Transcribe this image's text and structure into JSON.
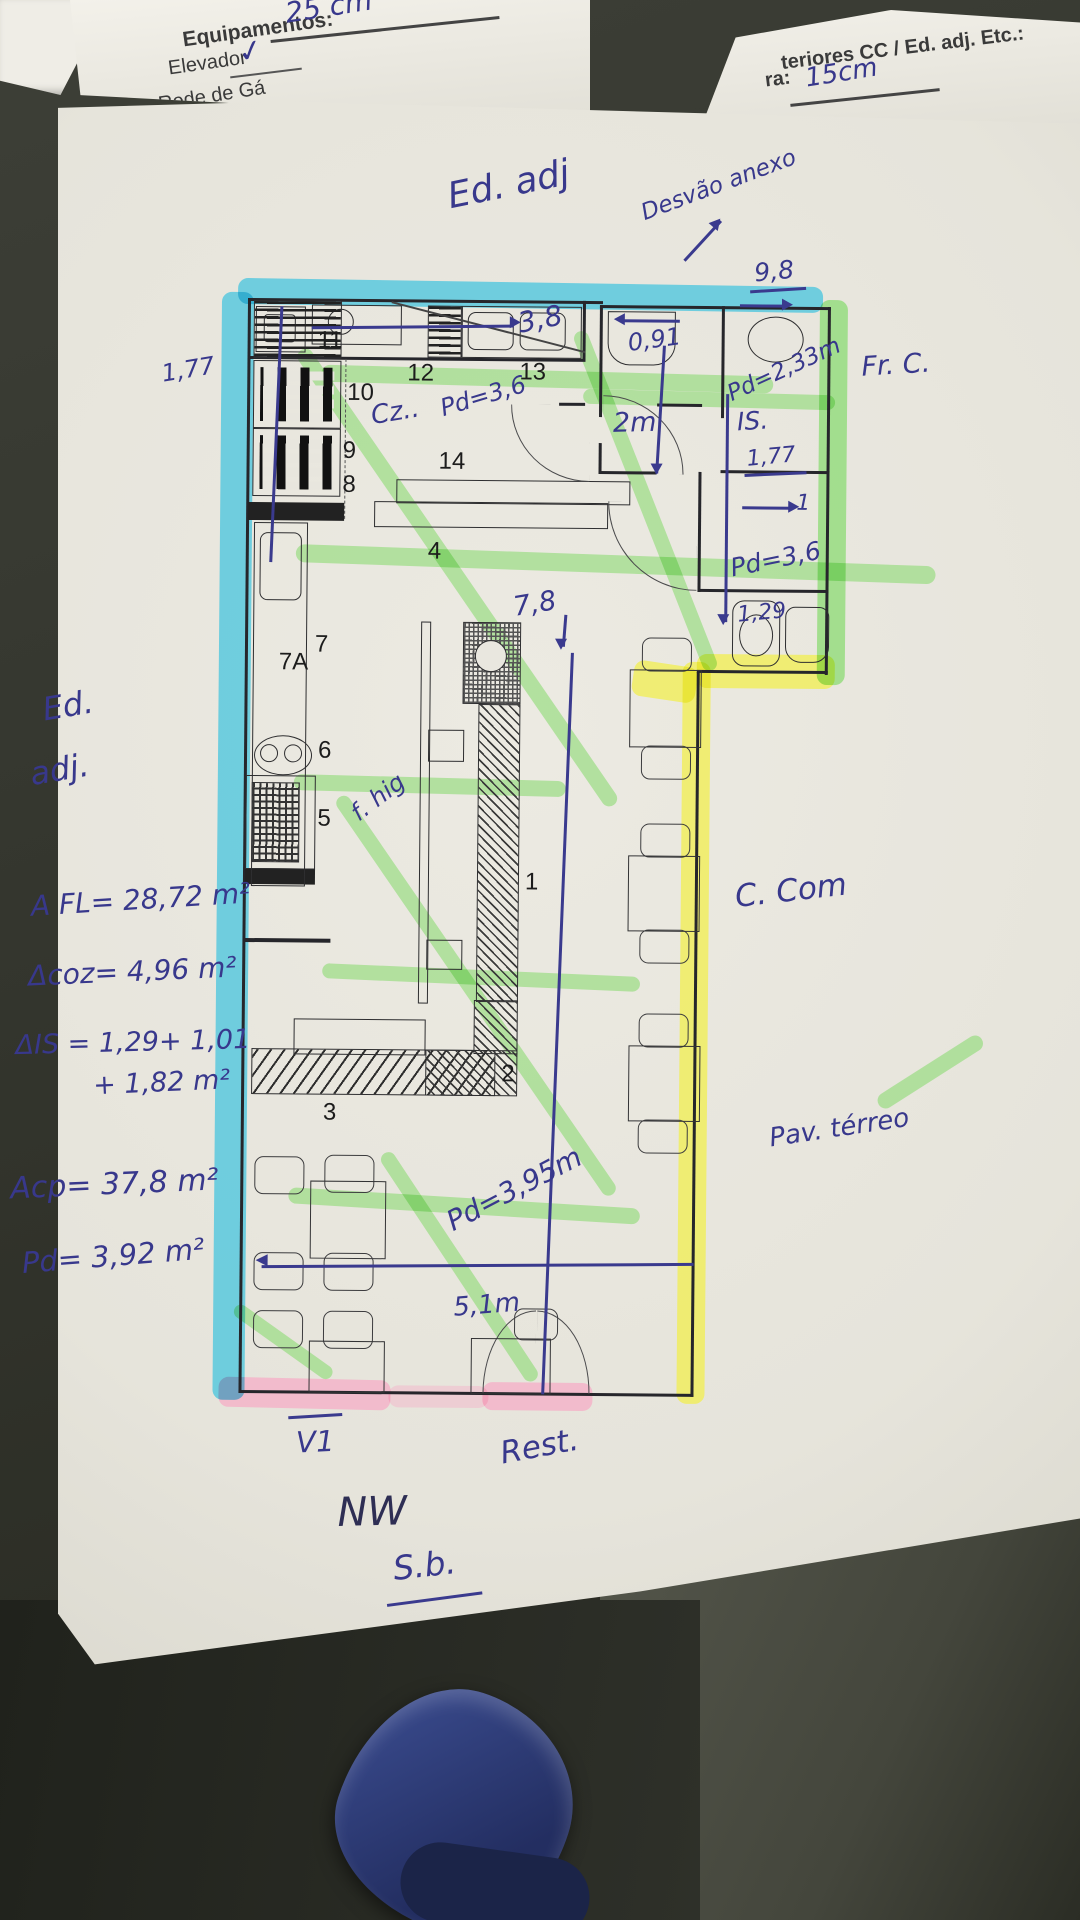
{
  "back_sheet_left": {
    "title": "Equipamentos:",
    "item1": "Elevador",
    "item2": "Rede de Gá",
    "check": "✓",
    "top_note": "25 cm"
  },
  "back_sheet_right": {
    "header": "teriores CC / Ed. adj. Etc.:",
    "field_label": "ra:",
    "field_value": "15cm"
  },
  "plan": {
    "rooms": [
      "11",
      "12",
      "13",
      "10",
      "9",
      "8",
      "14",
      "7",
      "7A",
      "6",
      "5",
      "4",
      "1",
      "2",
      "3"
    ]
  },
  "annotations": {
    "top": {
      "ed_adj": "Ed. adj",
      "desvao": "Desvão anexo"
    },
    "measures": {
      "m38": "3,8",
      "m091": "0,91",
      "m98": "9,8",
      "pd233": "Pd=2,33m",
      "is_label": "IS.",
      "m177_right": "1,77",
      "m2m": "2m",
      "one": "1",
      "pd36_corridor": "Pd=3,6",
      "m129": "1,29",
      "m177_left": "1,77",
      "cz": "Cz..",
      "pd36_kitchen": "Pd=3,6",
      "m78": "7,8",
      "f_hig": "f. hig",
      "pd395": "Pd=3,95m",
      "m51": "5,1m"
    },
    "areas": {
      "ed": "Ed.",
      "adj": "adj.",
      "line1": "A FL= 28,72 m²",
      "line2": "Δcoz= 4,96 m²",
      "line3": "ΔIS = 1,29+ 1,01",
      "line4": "+ 1,82 m²",
      "line5": "Acp= 37,8 m²",
      "line6": "Pd= 3,92 m²"
    },
    "right": {
      "frc": "Fr. C.",
      "ccom": "C. Com",
      "pav": "Pav. térreo"
    },
    "bottom": {
      "v1": "V1",
      "rest": "Rest.",
      "nw": "NW",
      "sb": "S.b."
    }
  }
}
